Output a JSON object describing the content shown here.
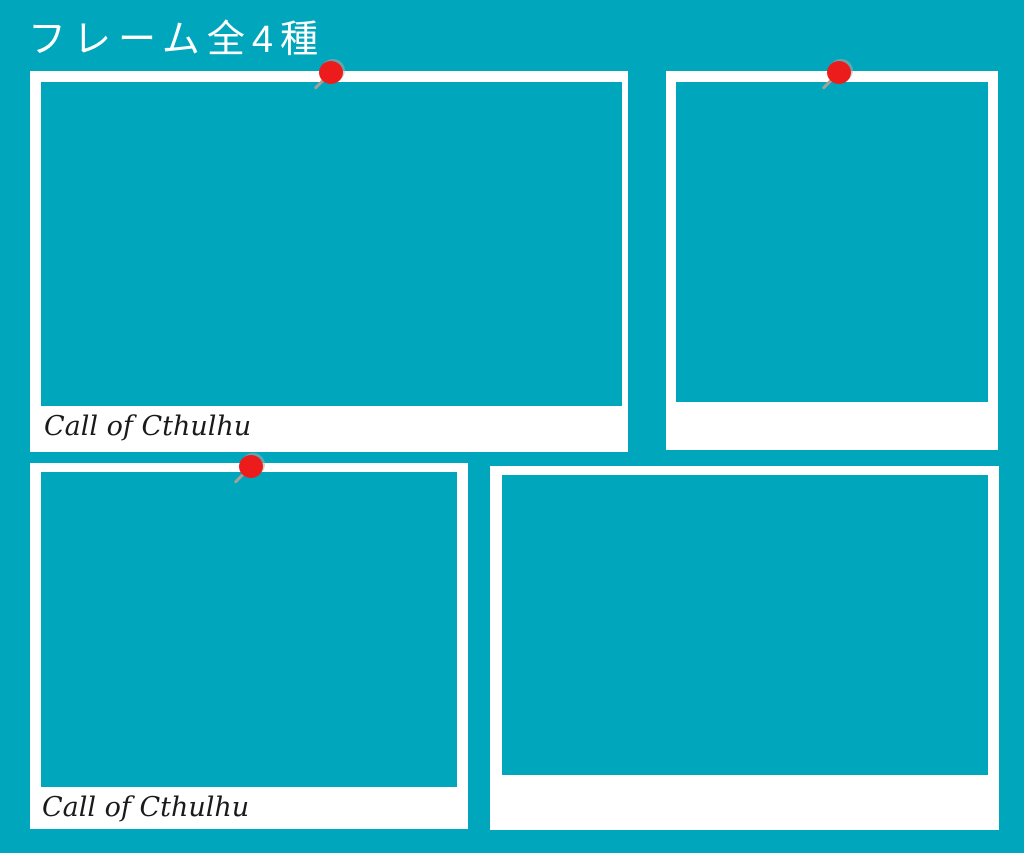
{
  "page": {
    "title": "フレーム全4種"
  },
  "colors": {
    "background": "#00a7bc",
    "frame_white": "#ffffff",
    "pin_head_red": "#ed1c1c",
    "pin_needle_gray": "#a89f97",
    "caption_black": "#1a1a1a",
    "title_white": "#ffffff"
  },
  "frames": [
    {
      "name": "frame-top-left",
      "style": "landscape polaroid, pinned, captioned",
      "caption": "Call of Cthulhu",
      "pinned": true
    },
    {
      "name": "frame-top-right",
      "style": "square polaroid, pinned",
      "caption": "",
      "pinned": true
    },
    {
      "name": "frame-bottom-left",
      "style": "landscape polaroid, pinned, captioned",
      "caption": "Call of Cthulhu",
      "pinned": true
    },
    {
      "name": "frame-bottom-right",
      "style": "landscape polaroid, plain",
      "caption": "",
      "pinned": false
    }
  ]
}
